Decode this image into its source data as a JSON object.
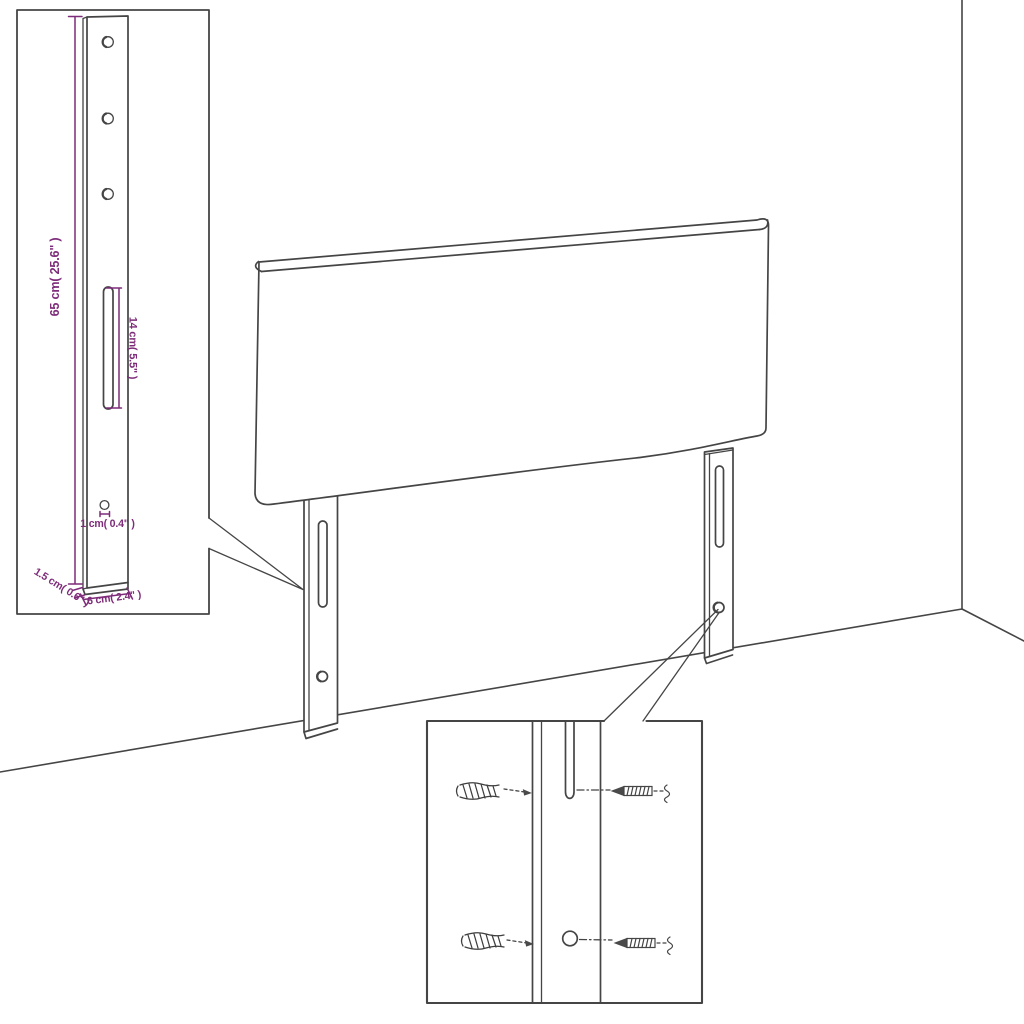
{
  "diagram": {
    "background": "#ffffff",
    "line_color": "#454545",
    "dimension_color": "#7e2c7a"
  },
  "leg_detail": {
    "height_label": "65 cm( 25.6\" )",
    "slot_label": "14 cm( 5.5\" )",
    "hole_label": "1 cm( 0.4\" )",
    "thickness_label": "1.5 cm( 0.6\" )",
    "width_label": "6 cm( 2.4\" )",
    "top_hole_count": 3
  },
  "hardware_detail": {
    "wall_plug_count": 2,
    "screw_count": 2,
    "mounting_hole_count": 1,
    "slot_count": 1
  }
}
